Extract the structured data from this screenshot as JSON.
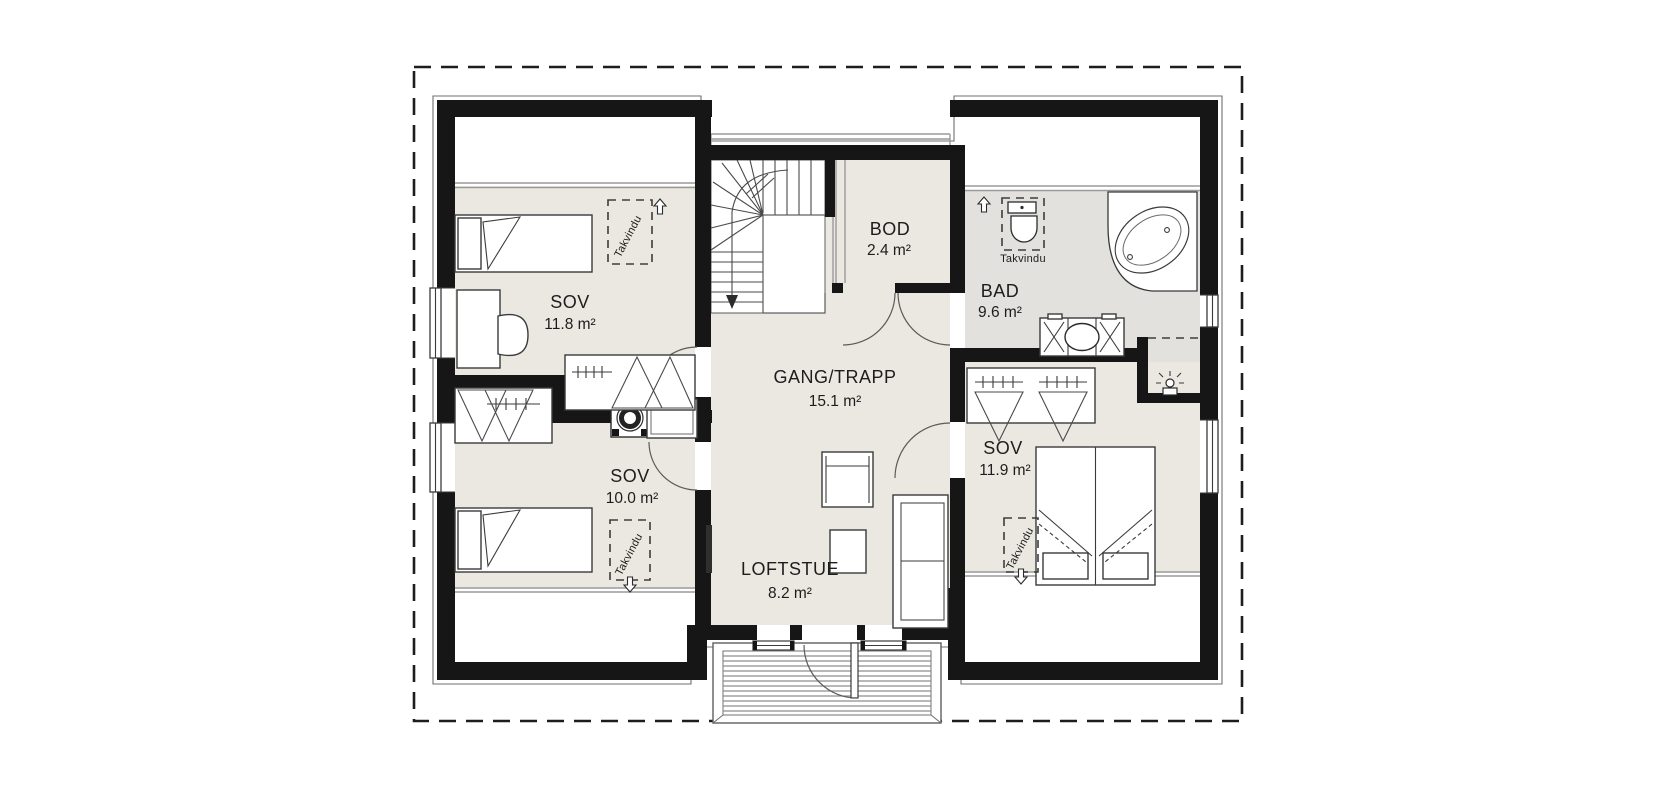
{
  "plan": {
    "rooms": [
      {
        "name": "SOV",
        "area": "11.8 m²"
      },
      {
        "name": "SOV",
        "area": "10.0 m²"
      },
      {
        "name": "GANG/TRAPP",
        "area": "15.1 m²"
      },
      {
        "name": "BOD",
        "area": "2.4 m²"
      },
      {
        "name": "BAD",
        "area": "9.6 m²"
      },
      {
        "name": "SOV",
        "area": "11.9 m²"
      },
      {
        "name": "LOFTSTUE",
        "area": "8.2 m²"
      }
    ],
    "labels": {
      "roof_window": "Takvindu"
    },
    "icons": {
      "roof_window_up_arrow": "outline up arrow",
      "roof_window_down_arrow": "outline down arrow",
      "stairs_direction": "curved arrow down"
    },
    "colors": {
      "wall": "#161616",
      "floor": "#eae8e1",
      "wet_room_floor": "#e2e1de",
      "background": "#ffffff"
    }
  }
}
